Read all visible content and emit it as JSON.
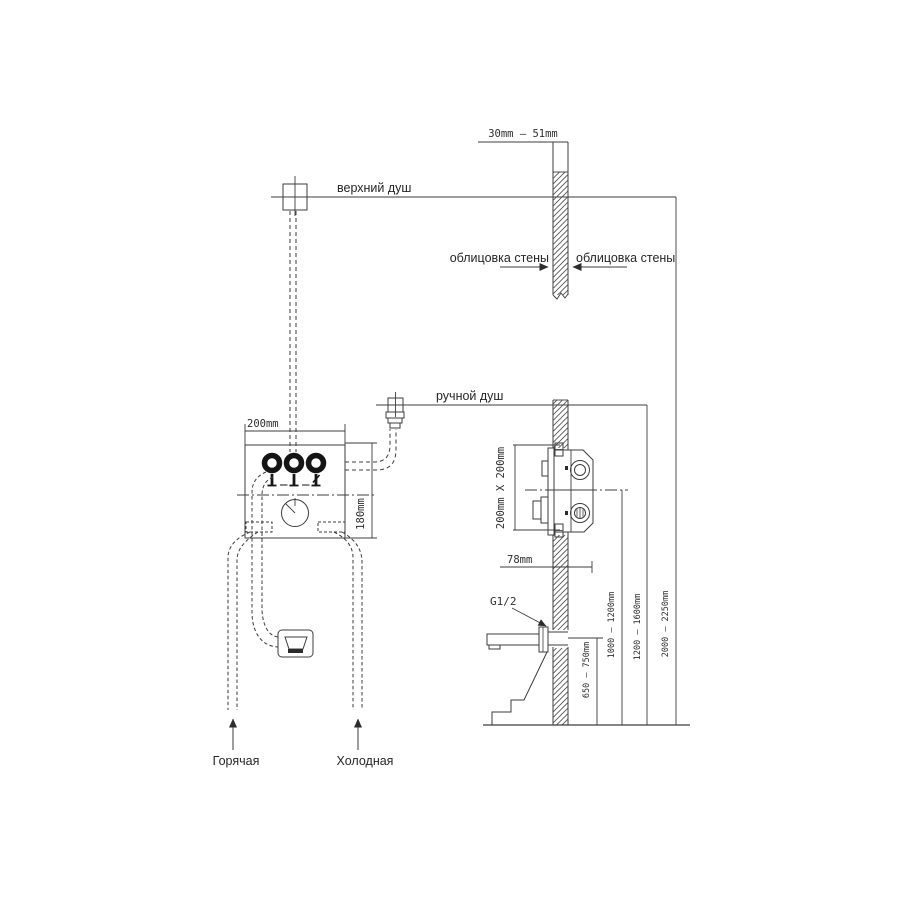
{
  "diagram": {
    "labels": {
      "upper_shower": "верхний душ",
      "hand_shower": "ручной душ",
      "wall_cladding_left": "облицовка стены",
      "wall_cladding_right": "облицовка стены",
      "hot_supply": "Горячая",
      "cold_supply": "Холодная",
      "thread_size": "G1/2"
    },
    "dimensions": {
      "cladding_thickness_range": "30mm – 51mm",
      "mixer_box_width": "200mm",
      "mixer_box_height": "180mm",
      "rough_in_box_size": "200mm X 200mm",
      "mixer_box_depth": "78mm",
      "spout_height_range": "650 – 750mm",
      "mixer_height_range": "1000 – 1200mm",
      "hand_shower_height_range": "1200 – 1600mm",
      "head_shower_height_range": "2000 – 2250mm"
    },
    "colors": {
      "line": "#3d3d3d",
      "bold_line": "#151515",
      "background": "#ffffff"
    }
  }
}
